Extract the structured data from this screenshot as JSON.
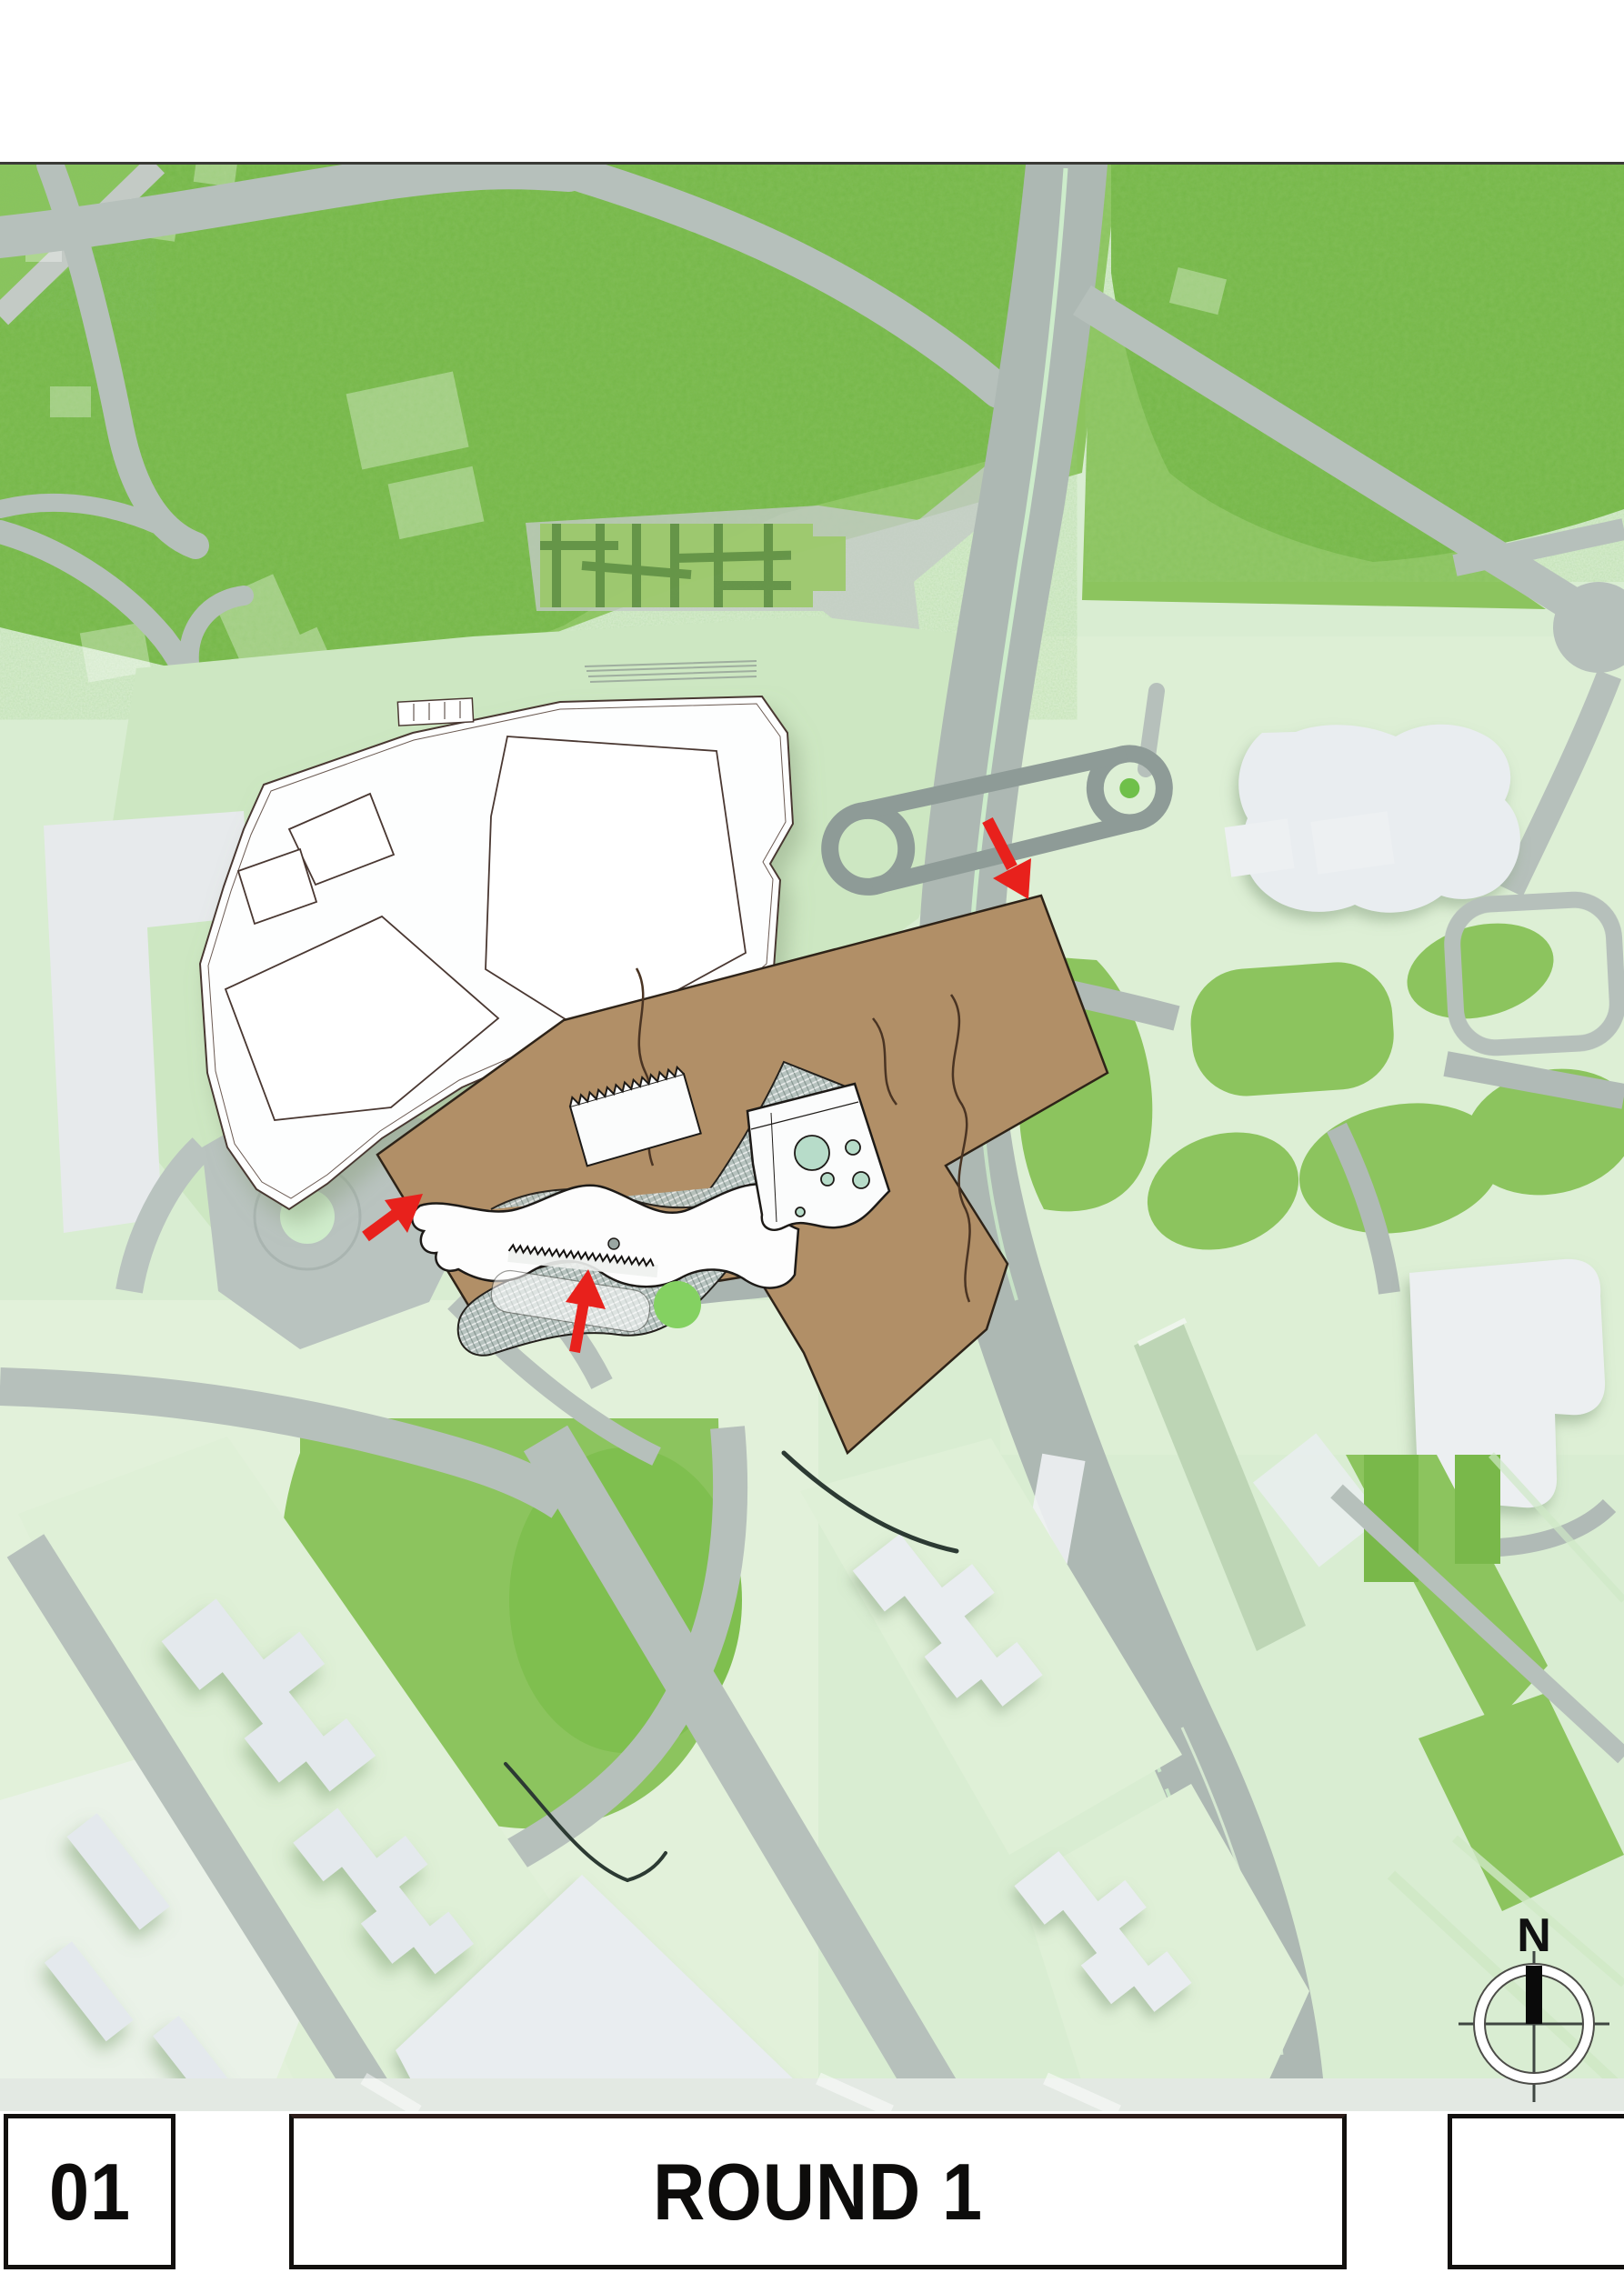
{
  "document": {
    "kind": "architectural masterplan site-plan sheet",
    "round_label": "ROUND 1",
    "sheet_number": "01"
  },
  "title_block": {
    "sheet_number": "01",
    "title": "ROUND 1",
    "notes_box": ""
  },
  "compass": {
    "north_label": "N"
  },
  "map": {
    "annotations": {
      "red_arrow_count": 3,
      "red_arrow_color": "#e8211c",
      "site_highlight": "development site shown in brown with proposed buildings, hatched deck and entrance arrows"
    },
    "colors": {
      "parkland_grass": "#74b644",
      "lawn_green": "#8cc45e",
      "hedge_green": "#5f9140",
      "pale_ground": "#d9edd2",
      "mall_apron": "#cde7c2",
      "road_gray": "#b6c0bb",
      "highway_gray": "#adb8b3",
      "bridge_loop_gray": "#8e9b97",
      "building_white": "#ffffff",
      "building_light_gray": "#e9edf0",
      "site_brown": "#b18f67",
      "hatch_deck_gray": "#b7c3bf",
      "courtyard_mint": "#b7dcc9",
      "accent_bright_green": "#84d161"
    }
  }
}
